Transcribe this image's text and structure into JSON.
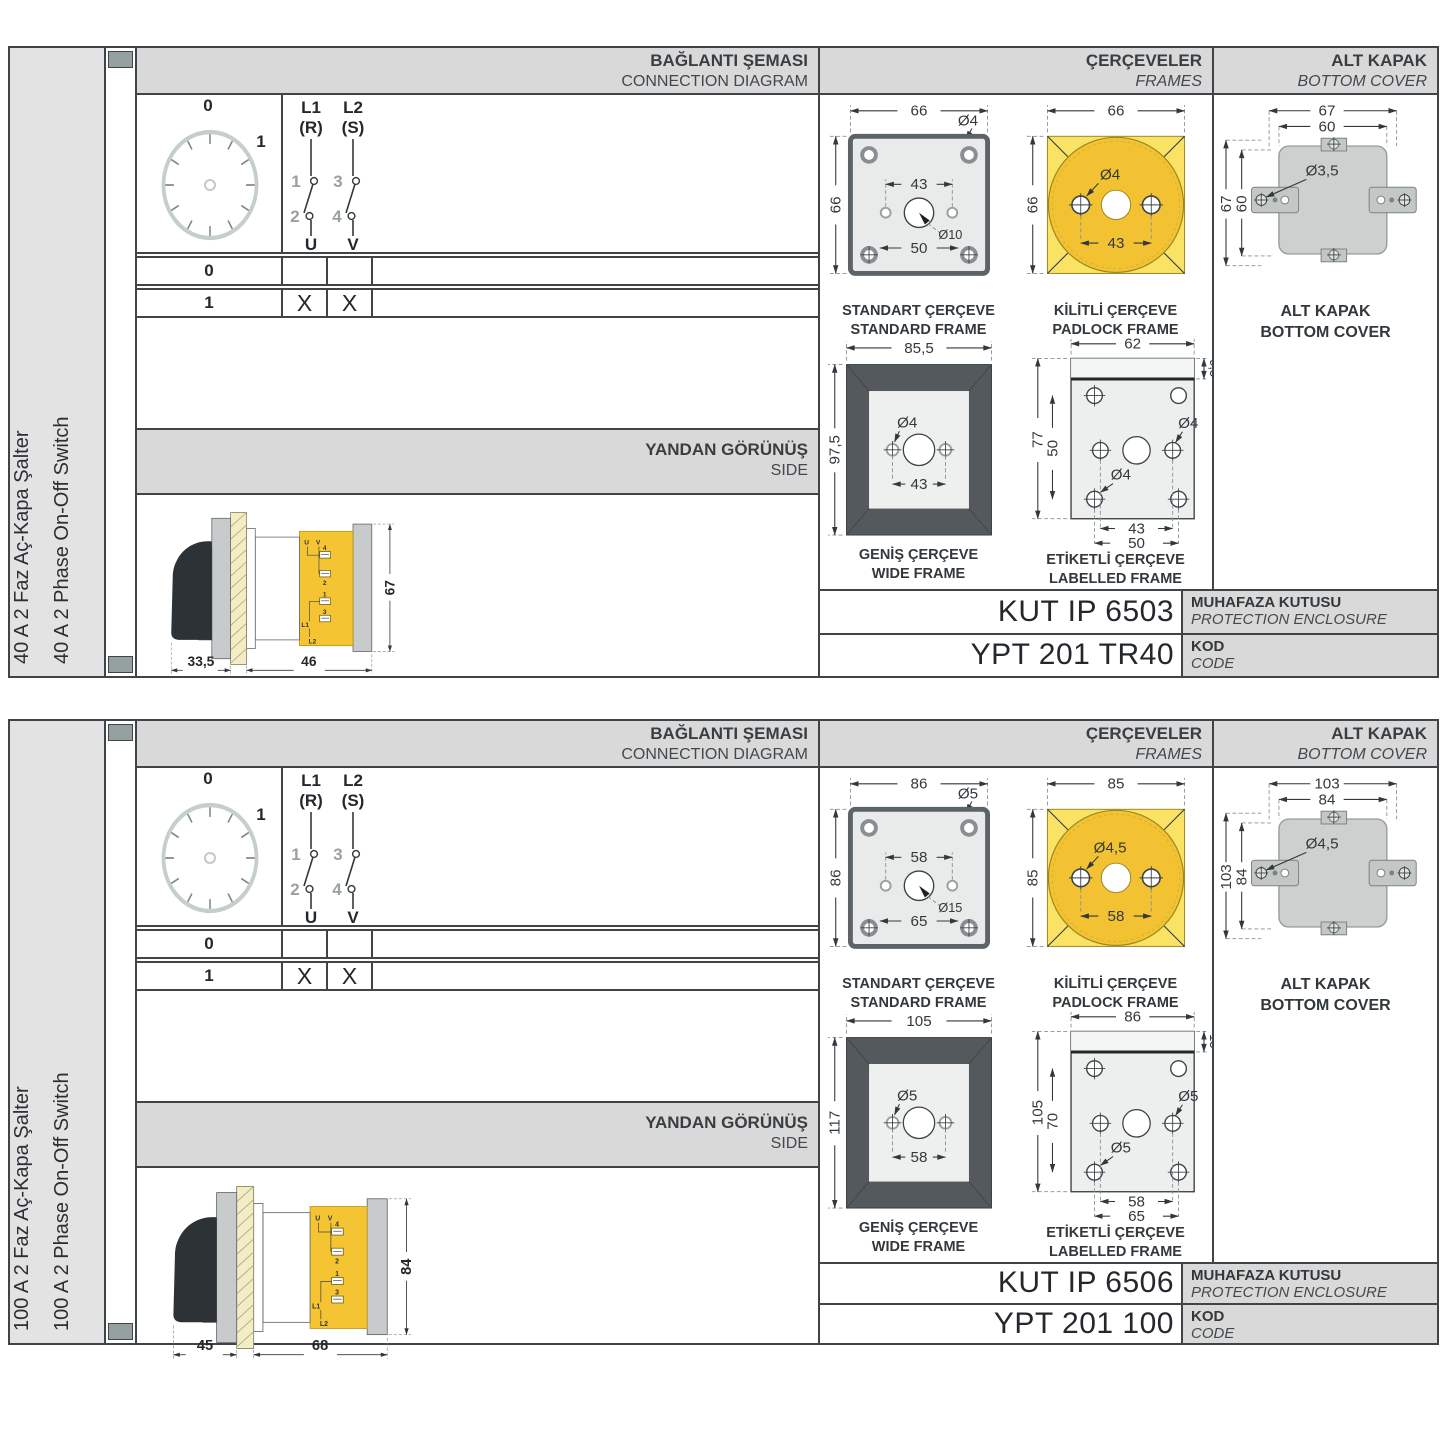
{
  "labels": {
    "connection": {
      "tr": "BAĞLANTI ŞEMASI",
      "en": "CONNECTION DIAGRAM"
    },
    "frames": {
      "tr": "ÇERÇEVELER",
      "en": "FRAMES"
    },
    "cover": {
      "tr": "ALT KAPAK",
      "en": "BOTTOM COVER"
    },
    "side": {
      "tr": "YANDAN GÖRÜNÜŞ",
      "en": "SIDE"
    },
    "standard_frame": {
      "tr": "STANDART ÇERÇEVE",
      "en": "STANDARD FRAME"
    },
    "padlock_frame": {
      "tr": "KİLİTLİ ÇERÇEVE",
      "en": "PADLOCK FRAME"
    },
    "wide_frame": {
      "tr": "GENİŞ ÇERÇEVE",
      "en": "WIDE FRAME"
    },
    "labelled_frame": {
      "tr": "ETİKETLİ ÇERÇEVE",
      "en": "LABELLED FRAME"
    },
    "cover_caption": {
      "tr": "ALT KAPAK",
      "en": "BOTTOM COVER"
    },
    "enclosure": {
      "tr": "MUHAFAZA KUTUSU",
      "en": "PROTECTION ENCLOSURE"
    },
    "code": {
      "tr": "KOD",
      "en": "CODE"
    }
  },
  "diagram": {
    "dial": [
      "0",
      "1"
    ],
    "poles": {
      "p1_line1": "L1",
      "p1_line2": "(R)",
      "p2_line1": "L2",
      "p2_line2": "(S)",
      "n1": "1",
      "n2": "2",
      "n3": "3",
      "n4": "4",
      "out1": "U",
      "out2": "V"
    },
    "table": {
      "rows": [
        {
          "position": "0",
          "u": "",
          "v": ""
        },
        {
          "position": "1",
          "u": "X",
          "v": "X"
        }
      ]
    }
  },
  "side_terminals": {
    "u": "U",
    "v": "V",
    "t4": "4",
    "t2": "2",
    "t1": "1",
    "t3": "3",
    "l1": "L1",
    "l2": "L2"
  },
  "sections": [
    {
      "name_tr": "40 A 2 Faz Aç-Kapa Şalter",
      "name_en": "40 A 2 Phase On-Off Switch",
      "side_view": {
        "depth_handle": "33,5",
        "depth_body": "46",
        "height": "67"
      },
      "standard_frame": {
        "width": "66",
        "height": "66",
        "hole": "Ø4",
        "hole_spacing": "43",
        "shaft": "Ø10",
        "screw_spacing": "50"
      },
      "padlock_frame": {
        "width": "66",
        "height": "66",
        "hole": "Ø4",
        "hole_spacing": "43"
      },
      "wide_frame": {
        "width": "85,5",
        "height": "97,5",
        "hole": "Ø4",
        "hole_spacing": "43"
      },
      "labelled_frame": {
        "width": "62",
        "label_height": "9,5",
        "height": "77",
        "inner_height": "50",
        "hole_right": "Ø4",
        "hole_left": "Ø4",
        "hole_spacing": "43",
        "screw_spacing": "50"
      },
      "bottom_cover": {
        "width": "67",
        "inner_width": "60",
        "height": "67",
        "inner_height": "60",
        "hole": "Ø3,5"
      },
      "codes": {
        "enclosure": "KUT IP 6503",
        "code": "YPT 201 TR40"
      }
    },
    {
      "name_tr": "100 A 2 Faz Aç-Kapa Şalter",
      "name_en": "100 A 2 Phase On-Off Switch",
      "side_view": {
        "depth_handle": "45",
        "depth_body": "68",
        "height": "84"
      },
      "standard_frame": {
        "width": "86",
        "height": "86",
        "hole": "Ø5",
        "hole_spacing": "58",
        "shaft": "Ø15",
        "screw_spacing": "65"
      },
      "padlock_frame": {
        "width": "85",
        "height": "85",
        "hole": "Ø4,5",
        "hole_spacing": "58"
      },
      "wide_frame": {
        "width": "105",
        "height": "117",
        "hole": "Ø5",
        "hole_spacing": "58"
      },
      "labelled_frame": {
        "width": "86",
        "label_height": "13",
        "height": "105",
        "inner_height": "70",
        "hole_right": "Ø5",
        "hole_left": "Ø5",
        "hole_spacing": "58",
        "screw_spacing": "65"
      },
      "bottom_cover": {
        "width": "103",
        "inner_width": "84",
        "height": "103",
        "inner_height": "84",
        "hole": "Ø4,5"
      },
      "codes": {
        "enclosure": "KUT IP 6506",
        "code": "YPT 201 100"
      }
    }
  ]
}
